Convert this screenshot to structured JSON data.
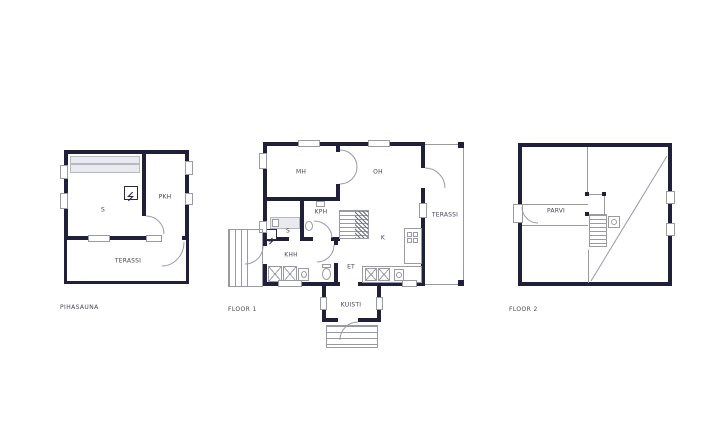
{
  "colors": {
    "wall": "#20203a",
    "thin_line": "#9a9aa6",
    "text": "#45455a",
    "bench_fill": "#e9eaef",
    "background": "#ffffff"
  },
  "icons": {
    "sauna-stove": "square-with-zigzag",
    "stairs": "treads-with-hatch",
    "chimney": "square-with-circle",
    "appliance": "square-with-x-cross",
    "wc": "oval-with-tank"
  },
  "plans": {
    "pihasauna": {
      "title": "PIHASAUNA",
      "rooms": {
        "sauna": "S",
        "dressing": "PKH",
        "terrace": "TERASSI"
      }
    },
    "floor1": {
      "title": "FLOOR 1",
      "rooms": {
        "bedroom": "MH",
        "living": "OH",
        "bathroom": "KPH",
        "sauna": "S",
        "utility": "KHH",
        "kitchen": "K",
        "entry": "ET",
        "porch": "KUISTI",
        "terrace": "TERASSI"
      }
    },
    "floor2": {
      "title": "FLOOR 2",
      "rooms": {
        "loft": "PARVI"
      }
    }
  }
}
